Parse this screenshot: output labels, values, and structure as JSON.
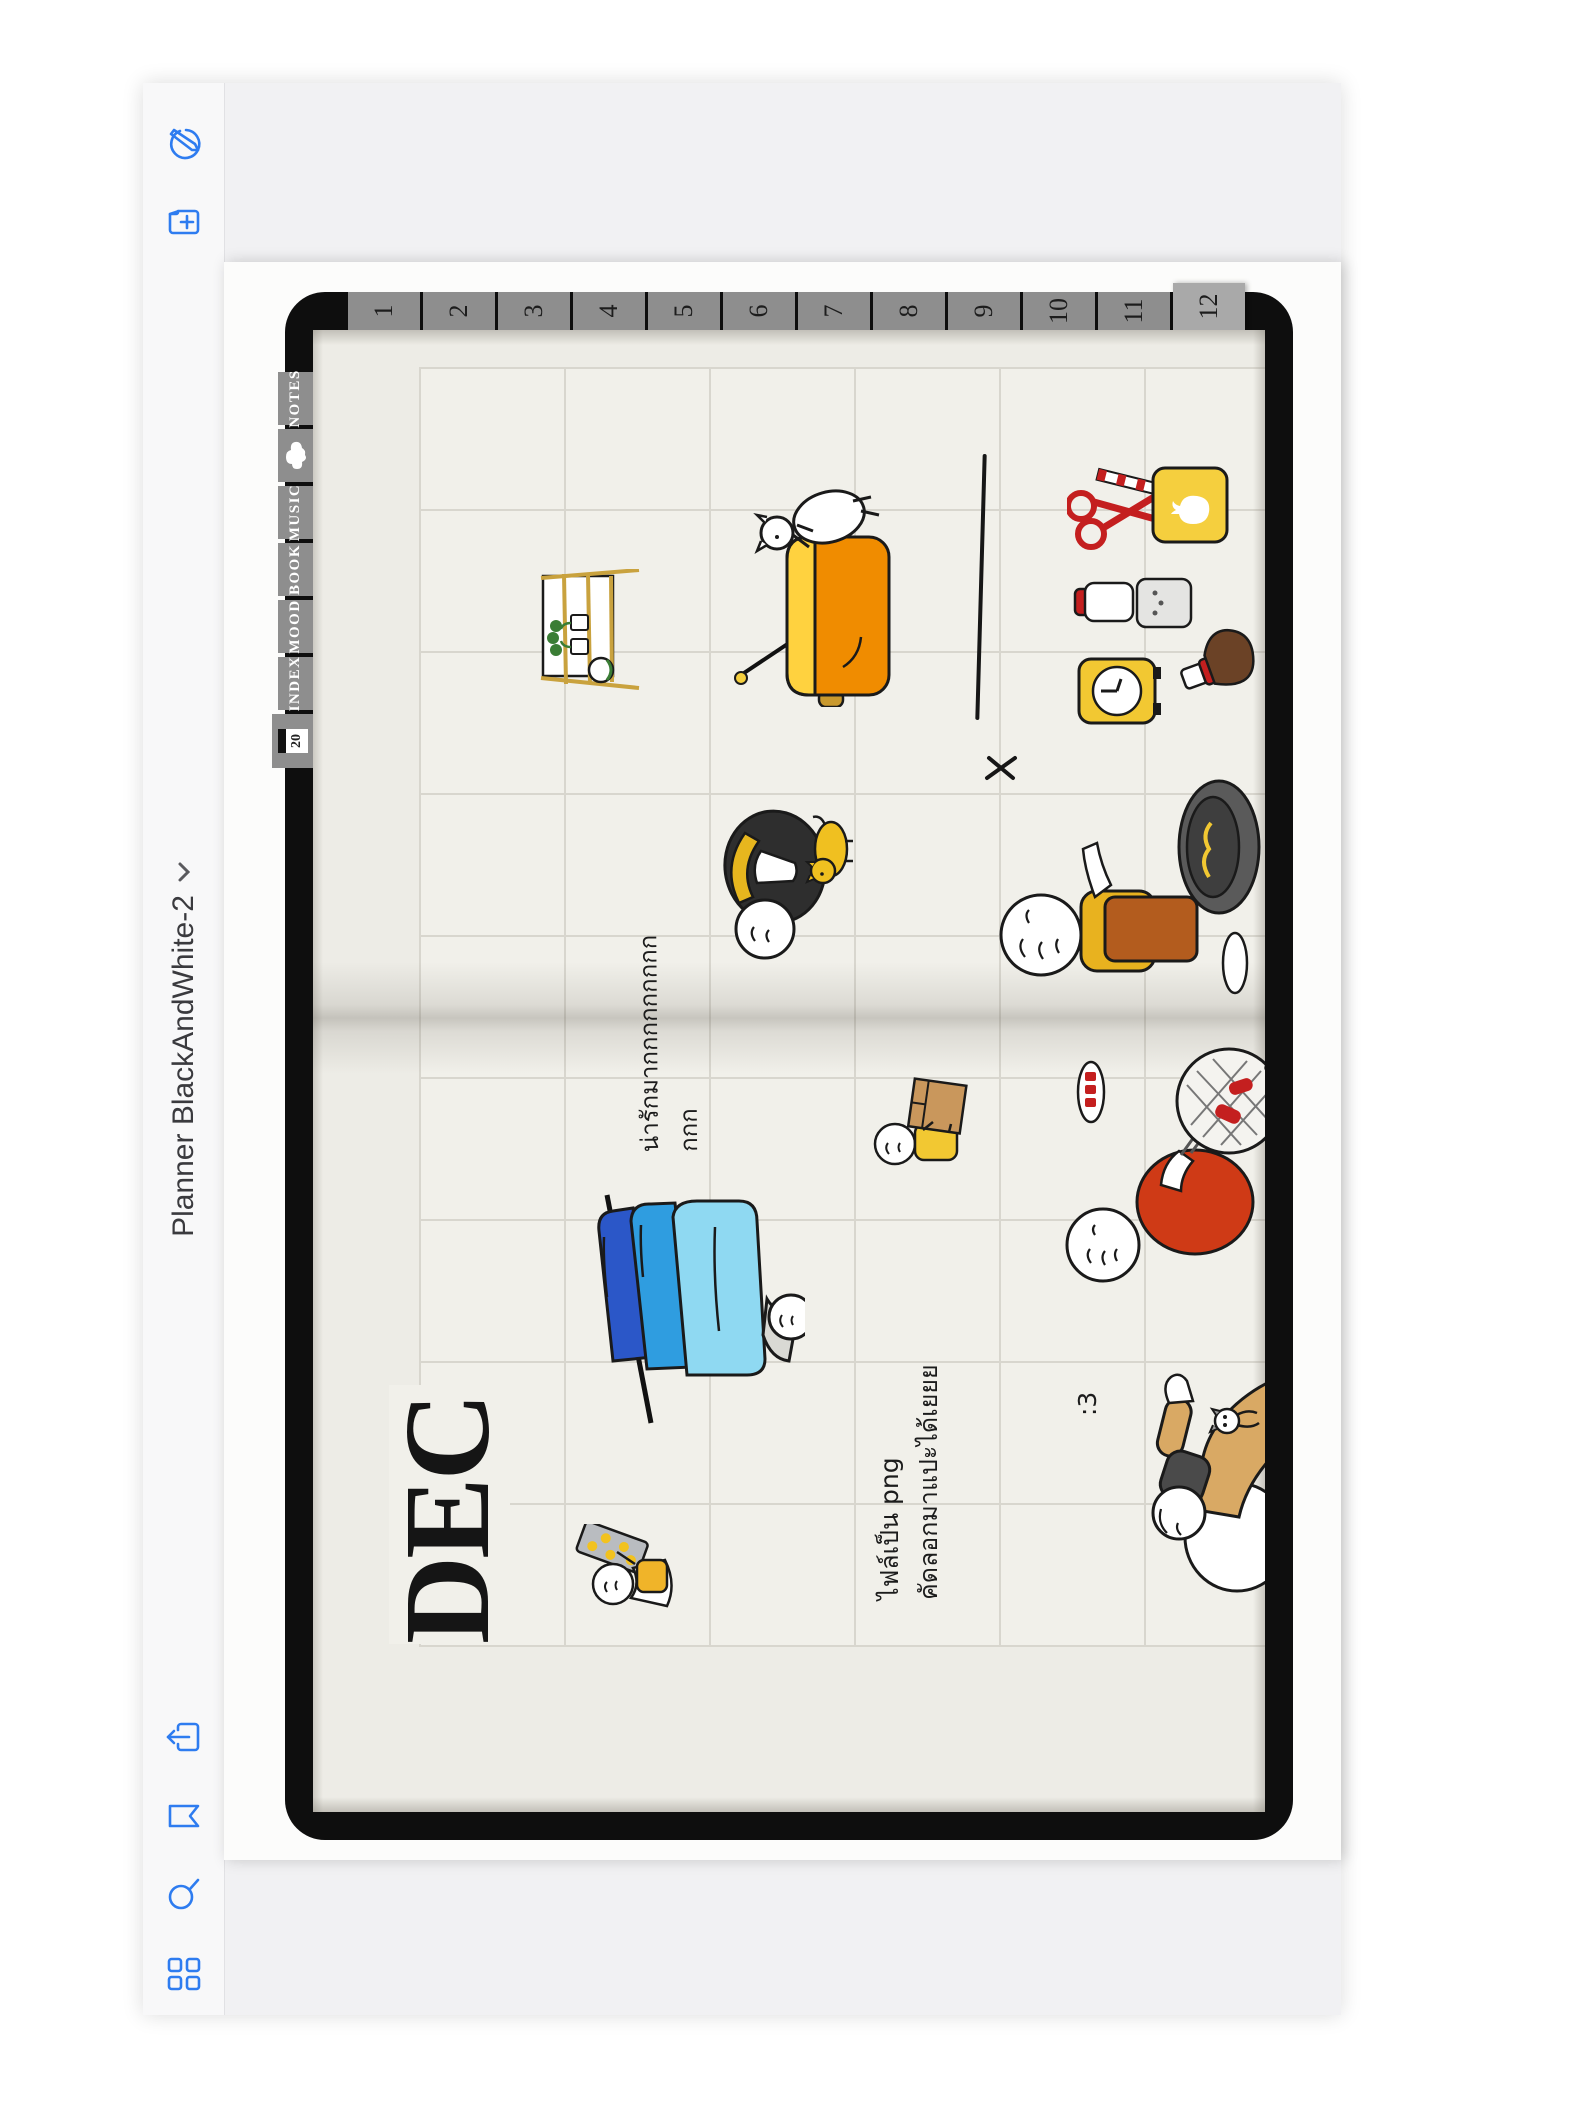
{
  "app": {
    "title": "Planner BlackAndWhite-2",
    "toolbar_icons": {
      "left": [
        "thumbnails-grid",
        "search",
        "bookmark",
        "share-export"
      ],
      "right": [
        "add-page",
        "pen-mode-toggle"
      ]
    }
  },
  "planner": {
    "month_title": "DEC",
    "month_tabs": [
      "1",
      "2",
      "3",
      "4",
      "5",
      "6",
      "7",
      "8",
      "9",
      "10",
      "11",
      "12"
    ],
    "active_month_tab": "12",
    "top_tabs": {
      "date_badge": "20",
      "index": "INDEX",
      "mood": "MOOD",
      "book": "BOOK",
      "music": "MUSIC",
      "notes": "NOTES"
    },
    "handwriting": {
      "cute_note": "น่ารักมากกกกกกกกกกกก",
      "file_note_line1": "ไฟล์เป็น png",
      "file_note_line2": "คัดลอกมาแปะได้เยยย",
      "emoticon": ":3"
    },
    "stickers": [
      "cheese-tray-person",
      "folded-jeans-stack",
      "box-carrier-person",
      "bbq-grill-person",
      "sack-with-cat-person",
      "plant-shelf",
      "goat-on-pot",
      "scissors-pencil-cup",
      "kitchen-timer-and-jars",
      "cooking-person-with-pot",
      "black-suit-person-with-dog",
      "x-mark",
      "cloud-sticker-tab",
      "chopstick"
    ]
  },
  "colors": {
    "icon_blue": "#2e7cf0",
    "notebook_black": "#0e0e0e",
    "paper_beige": "#edece6",
    "tab_gray": "#8e8e8e",
    "active_tab_gray": "#a9a9a9",
    "pot_orange": "#f08c00",
    "accent_yellow": "#f2c832",
    "accent_red": "#c41f1f",
    "jeans_dark_blue": "#2b57c8",
    "jeans_mid_blue": "#2f9de0",
    "jeans_light_blue": "#8fd9f2"
  }
}
